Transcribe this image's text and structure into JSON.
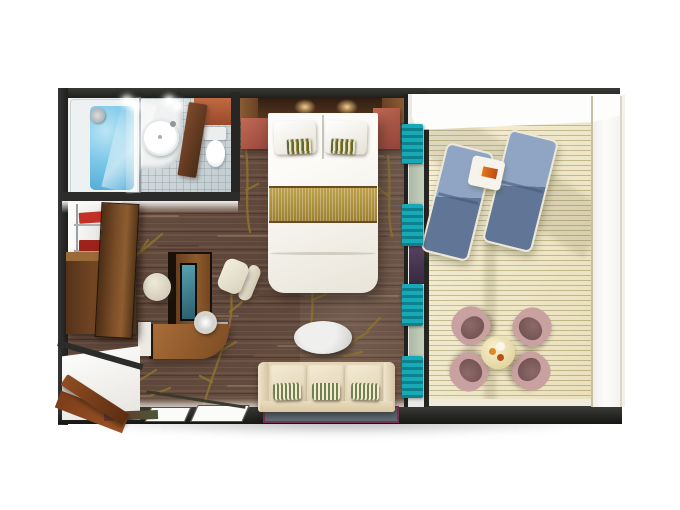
{
  "scene": {
    "type": "floor-plan-3d-render",
    "subject": "Top-down 3D rendered floor plan of a suite with bathroom, bedroom, living area, entry and private balcony",
    "background": "#ffffff"
  },
  "palette": {
    "wall_dark": "#2b2b2b",
    "carpet_brown": "#64493b",
    "carpet_streak_light": "#8d6f59",
    "branch_gold": "#8d7330",
    "bathroom_tile": "#ccd4d8",
    "bath_water_blue": "#79c6e6",
    "balcony_deck": "#e9dfb6",
    "curtain_teal": "#14a1af",
    "bed_linen_white": "#f4f1e8",
    "runner_gold": "#b49a42",
    "nightstand_red_wood": "#ad5c4c",
    "wood_cabinet": "#7a4c28",
    "sofa_cream": "#e9dcc2",
    "pillow_green": "#6e7c4a",
    "lounger_blue": "#7e94b8",
    "chair_mauve": "#c7a09f",
    "table_cream": "#efe5c3",
    "tv_screen_teal": "#3f7d8c",
    "rug_border_maroon": "#7a2f4e",
    "rug_center_blue": "#57656f"
  },
  "rooms": {
    "bathroom": {
      "label": "Bathroom"
    },
    "bedroom": {
      "label": "Bedroom"
    },
    "living": {
      "label": "Living area"
    },
    "entry": {
      "label": "Entry"
    },
    "balcony": {
      "label": "Private balcony"
    }
  },
  "furniture": {
    "bathtub": {
      "label": "Bathtub with water"
    },
    "shower": {
      "label": "Shower head"
    },
    "washbasin": {
      "label": "Round washbasin"
    },
    "toilet": {
      "label": "Toilet"
    },
    "bathroom_door": {
      "label": "Bathroom door"
    },
    "headboard": {
      "label": "Headboard with reading lights"
    },
    "nightstand_left": {
      "label": "Nightstand"
    },
    "nightstand_right": {
      "label": "Nightstand"
    },
    "bed": {
      "label": "Double bed with gold runner"
    },
    "wardrobe": {
      "label": "Wardrobe shelves"
    },
    "dresser": {
      "label": "Wooden dresser"
    },
    "wardrobe_door": {
      "label": "Wardrobe door"
    },
    "tv_panel": {
      "label": "TV panel"
    },
    "desk": {
      "label": "Curved desk"
    },
    "desk_lamp": {
      "label": "Desk lamp"
    },
    "desk_chair": {
      "label": "Desk chair"
    },
    "pouf": {
      "label": "Round pouf"
    },
    "sofa": {
      "label": "Three-seat sofa with striped pillows"
    },
    "coffee_table": {
      "label": "Oval coffee table"
    },
    "rug": {
      "label": "Rug"
    },
    "entry_door": {
      "label": "Entry door"
    },
    "lounger_1": {
      "label": "Sun lounger"
    },
    "lounger_2": {
      "label": "Sun lounger"
    },
    "lounger_table": {
      "label": "Side table with book"
    },
    "dining_table": {
      "label": "Round balcony table with drinks"
    },
    "dining_chair": {
      "label": "Balcony chair"
    },
    "curtains": {
      "label": "Teal curtains"
    },
    "railing": {
      "label": "Balcony railing"
    }
  }
}
